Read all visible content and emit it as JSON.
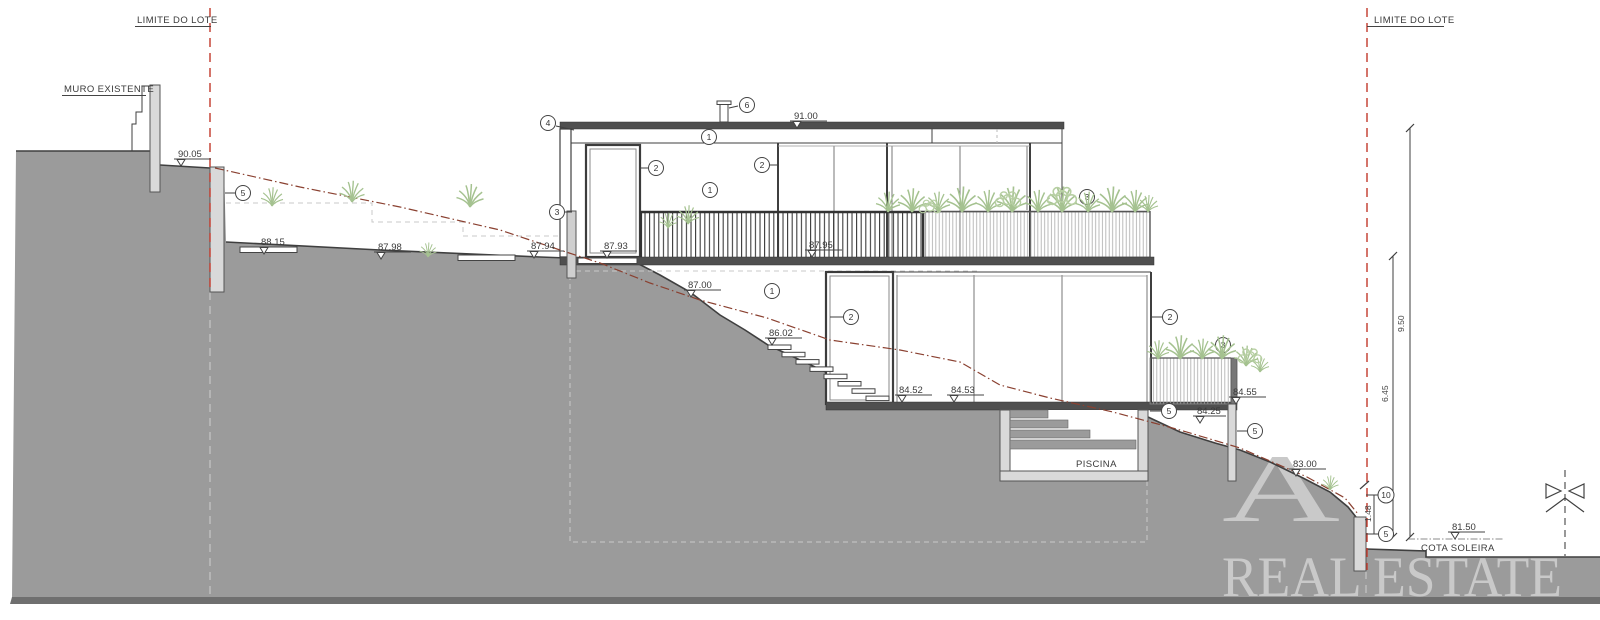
{
  "labels": {
    "limit_left": "LIMITE DO LOTE",
    "limit_right": "LIMITE DO LOTE",
    "muro": "MURO EXISTENTE",
    "piscina": "PISCINA",
    "cota": "COTA SOLEIRA"
  },
  "elevations": {
    "e9005": "90.05",
    "e9100": "91.00",
    "e8815": "88.15",
    "e8798": "87.98",
    "e8794": "87.94",
    "e8793": "87.93",
    "e8795": "87.95",
    "e8700": "87.00",
    "e8602": "86.02",
    "e8452": "84.52",
    "e8453": "84.53",
    "e8455": "84.55",
    "e8425": "84.25",
    "e8300": "83.00",
    "e8150": "81.50"
  },
  "dimensions": {
    "d950": "9.50",
    "d645": "6.45",
    "d148": "1.48"
  },
  "callouts": {
    "c4": "4",
    "c6": "6",
    "c1_roof": "1",
    "c2_door_up": "2",
    "c2_win_up": "2",
    "c1_wall_up": "1",
    "c3_wall": "3",
    "c3_planter_up": "3",
    "c5_limit": "5",
    "c1_low": "1",
    "c2_door_low": "2",
    "c2_win_low": "2",
    "c3_planter_low": "3",
    "c5_slab": "5",
    "c5_wall_mid": "5",
    "c10": "10",
    "c5_wall_low": "5"
  },
  "watermark": {
    "line1": "A",
    "line2": "REAL ESTATE"
  },
  "colors": {
    "terrain": "#9b9b9b",
    "terrain_band": "#6f6f6f",
    "line": "#3f3f3f",
    "wall_fill": "#d9d9d9",
    "lot_limit_red": "#c2392b",
    "existing_terrain_line": "#8a4030",
    "vegetation": "#a5c290",
    "watermark": "#c9c9c9"
  }
}
